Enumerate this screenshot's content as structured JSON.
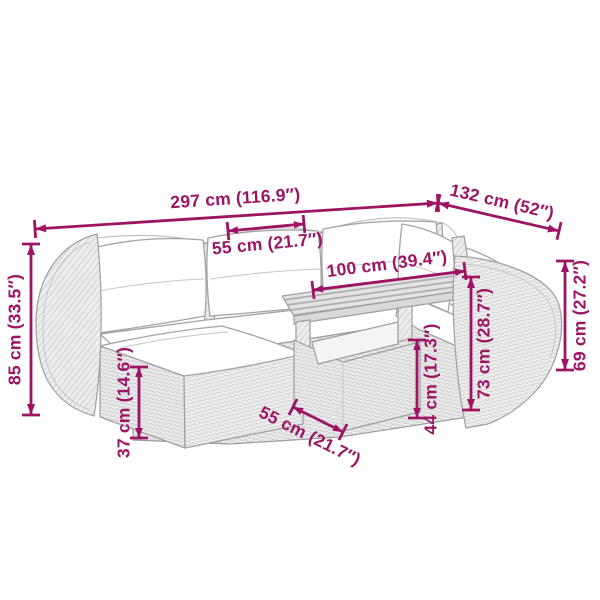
{
  "diagram": {
    "kind": "product-dimension-diagram",
    "subject": "rattan-garden-lounge-set-with-table-and-ottoman",
    "accent_color": "#9D1463",
    "outline_color": "#a3a3a3",
    "background": "#ffffff"
  },
  "dimensions": [
    {
      "id": "total-width",
      "label": "297 cm (116.9″)"
    },
    {
      "id": "wing-depth",
      "label": "132 cm (52″)"
    },
    {
      "id": "seat-width",
      "label": "55 cm (21.7″)"
    },
    {
      "id": "table-length",
      "label": "100 cm (39.4″)"
    },
    {
      "id": "total-height",
      "label": "85 cm (33.5″)"
    },
    {
      "id": "ottoman-height",
      "label": "37 cm (14.6″)"
    },
    {
      "id": "table-depth",
      "label": "55 cm (21.7″)"
    },
    {
      "id": "table-height",
      "label": "44 cm (17.3″)"
    },
    {
      "id": "backrest-height",
      "label": "73 cm (28.7″)"
    },
    {
      "id": "armrest-height",
      "label": "69 cm (27.2″)"
    }
  ]
}
